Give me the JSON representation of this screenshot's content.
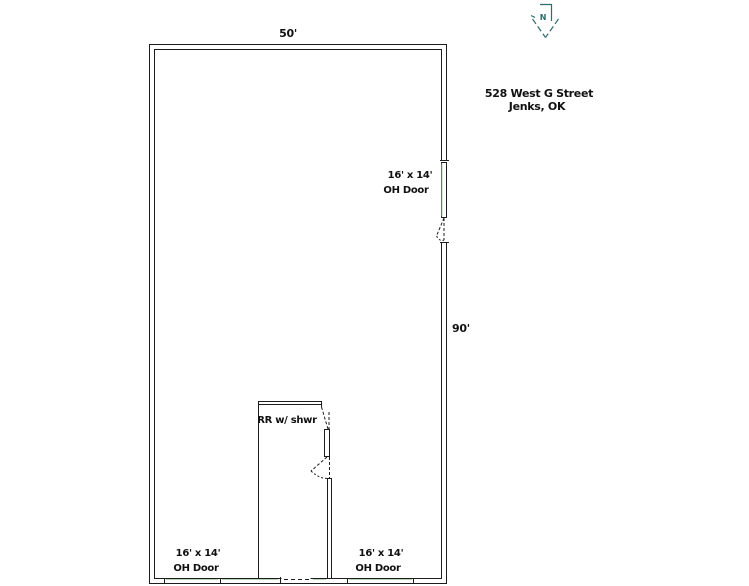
{
  "plan": {
    "address": {
      "line1": "528 West G Street",
      "line2": "Jenks, OK"
    },
    "dimensions": {
      "width_label": "50'",
      "height_label": "90'"
    },
    "north": {
      "label": "N"
    },
    "room": {
      "label": "RR w/ shwr"
    },
    "doors": {
      "right_wall": {
        "size": "16' x 14'",
        "type": "OH Door"
      },
      "bottom_left": {
        "size": "16' x 14'",
        "type": "OH Door"
      },
      "bottom_right": {
        "size": "16' x 14'",
        "type": "OH Door"
      }
    },
    "colors": {
      "line": "#1c1c1c",
      "door_panel": "#b2d4b2",
      "north_arrow": "#2e6b6b",
      "text": "#111111"
    }
  }
}
